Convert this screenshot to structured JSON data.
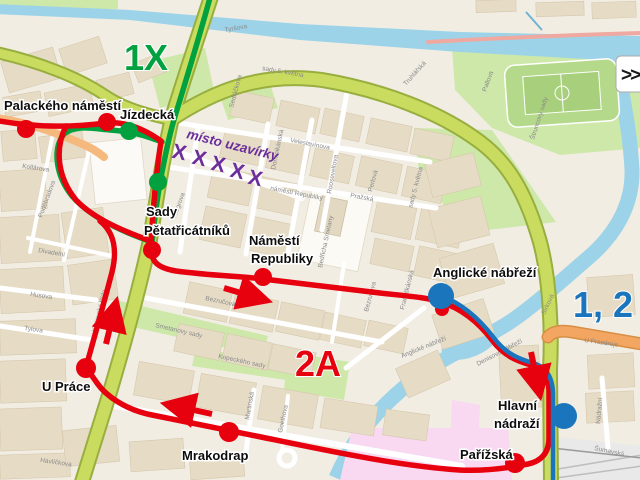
{
  "map": {
    "colors": {
      "background": "#F1EDE3",
      "route_red": "#E7000E",
      "route_green": "#00A13E",
      "route_blue": "#1B75BC",
      "closure_purple": "#6C2D9C",
      "road_green_fill": "#C9DC5F",
      "road_green_casing": "#98AE3F",
      "road_orange": "#F2A661",
      "river_blue": "#9CD3E8",
      "park_green": "#CDE8A9",
      "building_tan": "#E6DCC6",
      "pink_zone": "#F8D9F1"
    },
    "big_labels": [
      {
        "id": "line-1x",
        "text": "1X",
        "x": 124,
        "y": 70,
        "color": "#00A13E"
      },
      {
        "id": "line-2a",
        "text": "2A",
        "x": 295,
        "y": 376,
        "color": "#E7000E"
      },
      {
        "id": "lines-1-2",
        "text": "1, 2",
        "x": 573,
        "y": 317,
        "color": "#1B75BC"
      }
    ],
    "stop_labels": [
      {
        "text": "Palackého náměstí",
        "x": 4,
        "y": 110
      },
      {
        "text": "Jízdecká",
        "x": 120,
        "y": 119
      },
      {
        "text": "Sady",
        "x": 146,
        "y": 216
      },
      {
        "text": "Pětatřicátníků",
        "x": 144,
        "y": 235
      },
      {
        "text": "Náměstí",
        "x": 249,
        "y": 245
      },
      {
        "text": "Republiky",
        "x": 251,
        "y": 263
      },
      {
        "text": "Anglické nábřeží",
        "x": 433,
        "y": 277
      },
      {
        "text": "U Práce",
        "x": 42,
        "y": 391
      },
      {
        "text": "Mrakodrap",
        "x": 182,
        "y": 460
      },
      {
        "text": "Hlavní",
        "x": 498,
        "y": 410
      },
      {
        "text": "nádraží",
        "x": 494,
        "y": 428
      },
      {
        "text": "Pařížská",
        "x": 460,
        "y": 459
      }
    ],
    "closure": {
      "label": "místo uzavírky",
      "x": 186,
      "y": 138,
      "rot": 14,
      "marks": [
        {
          "x": 178,
          "y": 159
        },
        {
          "x": 198,
          "y": 165
        },
        {
          "x": 217,
          "y": 171
        },
        {
          "x": 236,
          "y": 178
        },
        {
          "x": 254,
          "y": 185
        }
      ]
    },
    "stops": {
      "red": [
        {
          "x": 26,
          "y": 129,
          "r": 9
        },
        {
          "x": 107,
          "y": 122,
          "r": 9
        },
        {
          "x": 152,
          "y": 250,
          "r": 9
        },
        {
          "x": 263,
          "y": 277,
          "r": 9
        },
        {
          "x": 442,
          "y": 309,
          "r": 7
        },
        {
          "x": 86,
          "y": 368,
          "r": 10
        },
        {
          "x": 229,
          "y": 432,
          "r": 10
        },
        {
          "x": 515,
          "y": 463,
          "r": 10
        }
      ],
      "green": [
        {
          "x": 129,
          "y": 131,
          "r": 9
        },
        {
          "x": 158,
          "y": 182,
          "r": 9
        }
      ],
      "blue": [
        {
          "x": 441,
          "y": 296,
          "r": 13
        },
        {
          "x": 564,
          "y": 416,
          "r": 13
        }
      ]
    },
    "arrows": [
      {
        "x1": 106,
        "y1": 344,
        "x2": 114,
        "y2": 311
      },
      {
        "x1": 224,
        "y1": 288,
        "x2": 258,
        "y2": 298
      },
      {
        "x1": 212,
        "y1": 414,
        "x2": 175,
        "y2": 406
      },
      {
        "x1": 531,
        "y1": 352,
        "x2": 538,
        "y2": 386
      }
    ],
    "street_labels": [
      {
        "t": "Tyršova",
        "x": 225,
        "y": 32,
        "r": -10
      },
      {
        "t": "sady 5. května",
        "x": 262,
        "y": 70,
        "r": 10
      },
      {
        "t": "sady 5. května",
        "x": 412,
        "y": 208,
        "r": -75
      },
      {
        "t": "Veleslavínova",
        "x": 290,
        "y": 142,
        "r": 11
      },
      {
        "t": "Pražská",
        "x": 350,
        "y": 197,
        "r": 11
      },
      {
        "t": "náměstí Republiky",
        "x": 270,
        "y": 190,
        "r": 11
      },
      {
        "t": "Sedláčkova",
        "x": 233,
        "y": 108,
        "r": -75
      },
      {
        "t": "Dominikánská",
        "x": 275,
        "y": 170,
        "r": -78
      },
      {
        "t": "Rooseveltova",
        "x": 331,
        "y": 194,
        "r": -80
      },
      {
        "t": "Perlová",
        "x": 372,
        "y": 192,
        "r": -75
      },
      {
        "t": "Riegrova",
        "x": 176,
        "y": 218,
        "r": -70
      },
      {
        "t": "Bedřicha Smetany",
        "x": 322,
        "y": 268,
        "r": -78
      },
      {
        "t": "Františkánská",
        "x": 404,
        "y": 310,
        "r": -76
      },
      {
        "t": "Bezručova",
        "x": 205,
        "y": 300,
        "r": 12
      },
      {
        "t": "Bezručova",
        "x": 368,
        "y": 312,
        "r": -75
      },
      {
        "t": "Smetanovy sady",
        "x": 155,
        "y": 327,
        "r": 13
      },
      {
        "t": "Kopeckého sady",
        "x": 218,
        "y": 358,
        "r": 12
      },
      {
        "t": "Klatovská třída",
        "x": 96,
        "y": 332,
        "r": -76
      },
      {
        "t": "Husova",
        "x": 30,
        "y": 296,
        "r": 8
      },
      {
        "t": "Tylova",
        "x": 24,
        "y": 330,
        "r": 8
      },
      {
        "t": "Kollárova",
        "x": 22,
        "y": 168,
        "r": 8
      },
      {
        "t": "Poděbradova",
        "x": 42,
        "y": 218,
        "r": -70
      },
      {
        "t": "Divadelní",
        "x": 38,
        "y": 252,
        "r": 10
      },
      {
        "t": "Havlíčkova",
        "x": 40,
        "y": 462,
        "r": 8
      },
      {
        "t": "Martinská",
        "x": 249,
        "y": 420,
        "r": -80
      },
      {
        "t": "Goethova",
        "x": 282,
        "y": 433,
        "r": -78
      },
      {
        "t": "Anglické nábřeží",
        "x": 402,
        "y": 358,
        "r": -22
      },
      {
        "t": "Denisovo nábřeží",
        "x": 478,
        "y": 366,
        "r": -28
      },
      {
        "t": "Sirková",
        "x": 545,
        "y": 315,
        "r": -65
      },
      {
        "t": "Nádražní",
        "x": 600,
        "y": 424,
        "r": -85
      },
      {
        "t": "Šumavská",
        "x": 594,
        "y": 450,
        "r": 12
      },
      {
        "t": "U Prazdroje",
        "x": 584,
        "y": 342,
        "r": 8
      },
      {
        "t": "Štruncovy sady",
        "x": 534,
        "y": 140,
        "r": -72
      },
      {
        "t": "Pallova",
        "x": 486,
        "y": 92,
        "r": -70
      },
      {
        "t": "Truhlářská",
        "x": 406,
        "y": 86,
        "r": -48
      }
    ],
    "pan_control": ">>"
  }
}
